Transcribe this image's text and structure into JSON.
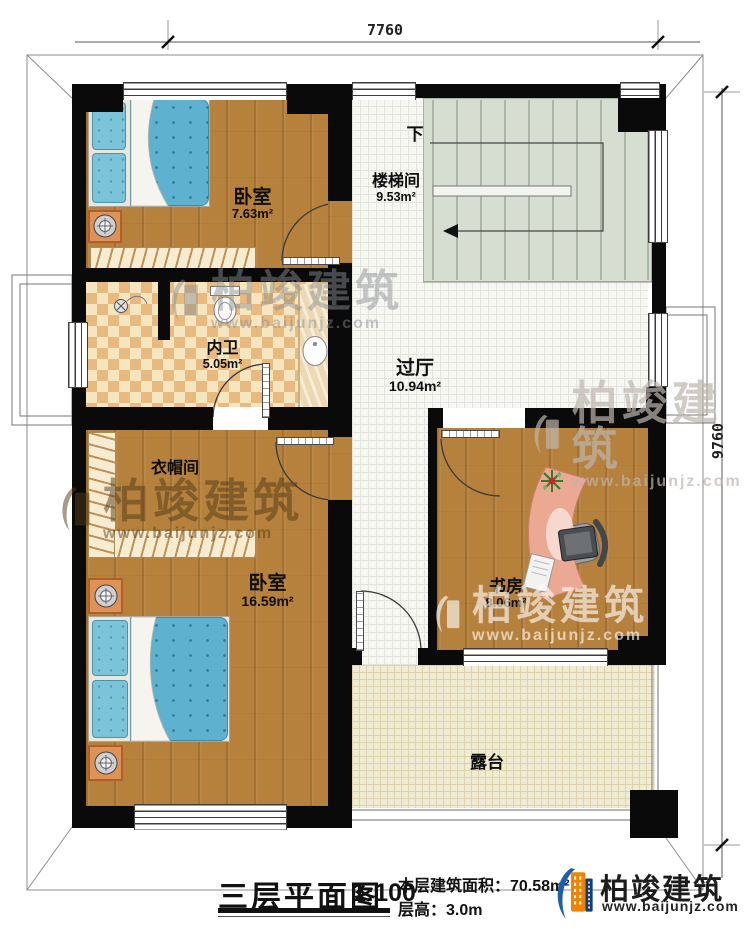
{
  "dimensions": {
    "width_mm": "7760",
    "height_mm": "9760"
  },
  "rooms": {
    "bedroom1": {
      "name": "卧室",
      "area": "7.63m²"
    },
    "stairwell": {
      "name": "楼梯间",
      "area": "9.53m²",
      "down_label": "下"
    },
    "bathroom": {
      "name": "内卫",
      "area": "5.05m²"
    },
    "hall": {
      "name": "过厅",
      "area": "10.94m²"
    },
    "cloakroom": {
      "name": "衣帽间"
    },
    "bedroom2": {
      "name": "卧室",
      "area": "16.59m²"
    },
    "study": {
      "name": "书房",
      "area": "8.06m²"
    },
    "terrace": {
      "name": "露台"
    }
  },
  "legend": {
    "plan_title": "三层平面图",
    "scale": "1:100",
    "floor_area": "本层建筑面积：70.58m²",
    "floor_height": "层高：3.0m"
  },
  "brand": {
    "name": "柏竣建筑",
    "website": "www.baijunjz.com"
  },
  "colors": {
    "brand_blue": "#1a5fa8",
    "brand_orange": "#f08300",
    "wall": "#0a0a0a"
  }
}
